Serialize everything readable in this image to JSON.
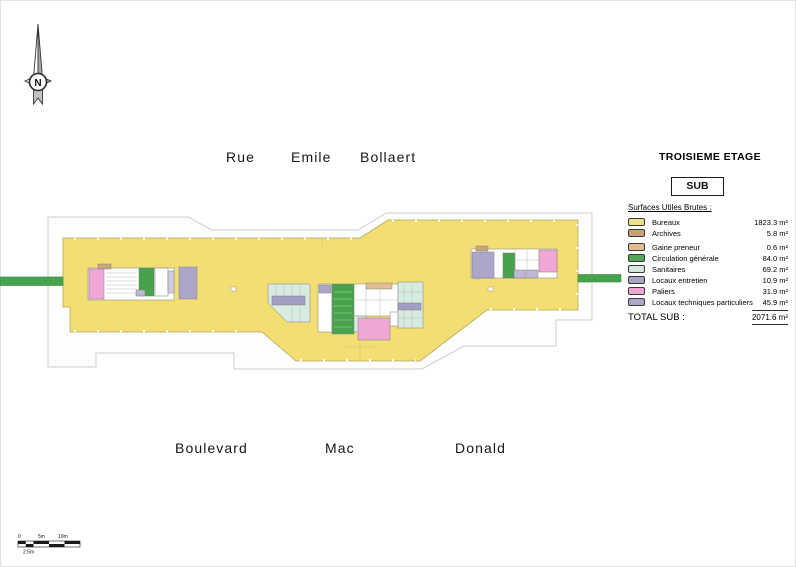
{
  "compass": {
    "label": "N"
  },
  "streets": {
    "top": [
      "Rue",
      "Emile",
      "Bollaert"
    ],
    "bottom": [
      "Boulevard",
      "Mac",
      "Donald"
    ]
  },
  "header": {
    "title": "TROISIEME ETAGE",
    "badge": "SUB"
  },
  "legend": {
    "heading": "Surfaces Utiles Brutes :",
    "items": [
      {
        "label": "Bureaux",
        "value": "1823.3 m²",
        "color": "#EDE08C"
      },
      {
        "label": "Archives",
        "value": "5.8 m²",
        "color": "#C8A179"
      },
      {
        "label": "Gaine preneur",
        "value": "0.6 m²",
        "color": "#E0BD92"
      },
      {
        "label": "Circulation générale",
        "value": "84.0 m²",
        "color": "#55A75A"
      },
      {
        "label": "Sanitaires",
        "value": "69.2 m²",
        "color": "#D3E7DC"
      },
      {
        "label": "Locaux entretien",
        "value": "10.9 m²",
        "color": "#A8A3C2"
      },
      {
        "label": "Paliers",
        "value": "31.9 m²",
        "color": "#ECA8D2"
      },
      {
        "label": "Locaux techniques particuliers",
        "value": "45.9 m²",
        "color": "#ADA8C9"
      }
    ],
    "total_label": "TOTAL SUB :",
    "total_value": "2071.6 m²"
  },
  "scalebar": {
    "labels_top": [
      "0",
      "5m",
      "10m"
    ],
    "label_bottom": "2.5m"
  },
  "plan_colors": {
    "bureaux": "#F3DE74",
    "circulation": "#46A24B",
    "sanitaires": "#D7EBE1",
    "paliers": "#EFA8D5",
    "locaux_techniques": "#ACA7CA",
    "locaux_entretien": "#A39EC2",
    "archives": "#C9A57B",
    "gaine": "#E2BE92"
  }
}
